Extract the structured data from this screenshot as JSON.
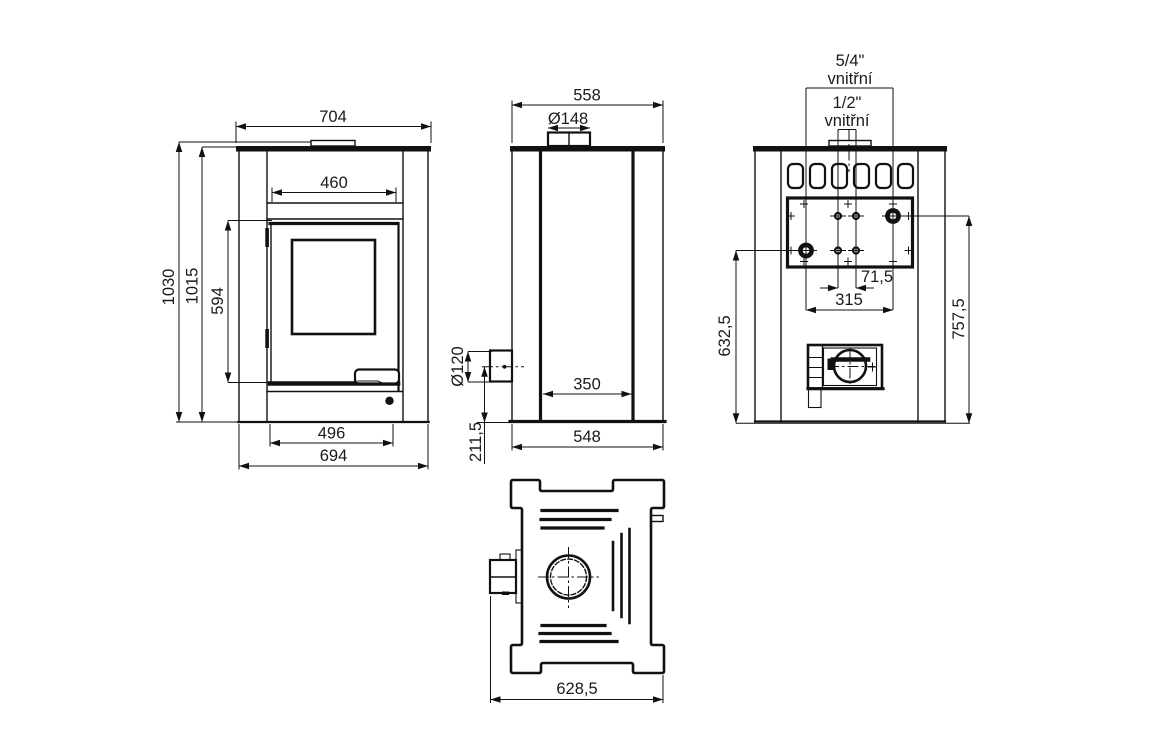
{
  "views": {
    "front": {
      "dims": {
        "top_width": "704",
        "glass_width": "460",
        "total_height": "1030",
        "body_height": "1015",
        "door_height": "594",
        "inner_base_width": "496",
        "base_width": "694"
      }
    },
    "side": {
      "dims": {
        "top_depth": "558",
        "flue_diameter": "Ø148",
        "pipe_diameter": "Ø120",
        "pipe_axis_height": "211,5",
        "inner_depth": "350",
        "base_depth": "548"
      }
    },
    "rear": {
      "labels": {
        "large_fitting_size": "5/4\"",
        "large_fitting_kind": "vnitřní",
        "small_fitting_size": "1/2\"",
        "small_fitting_kind": "vnitřní"
      },
      "dims": {
        "small_ports_spacing": "71,5",
        "large_ports_spacing": "315",
        "lower_port_height": "632,5",
        "upper_port_height": "757,5"
      }
    },
    "top": {
      "dims": {
        "overall_depth": "628,5"
      }
    }
  }
}
